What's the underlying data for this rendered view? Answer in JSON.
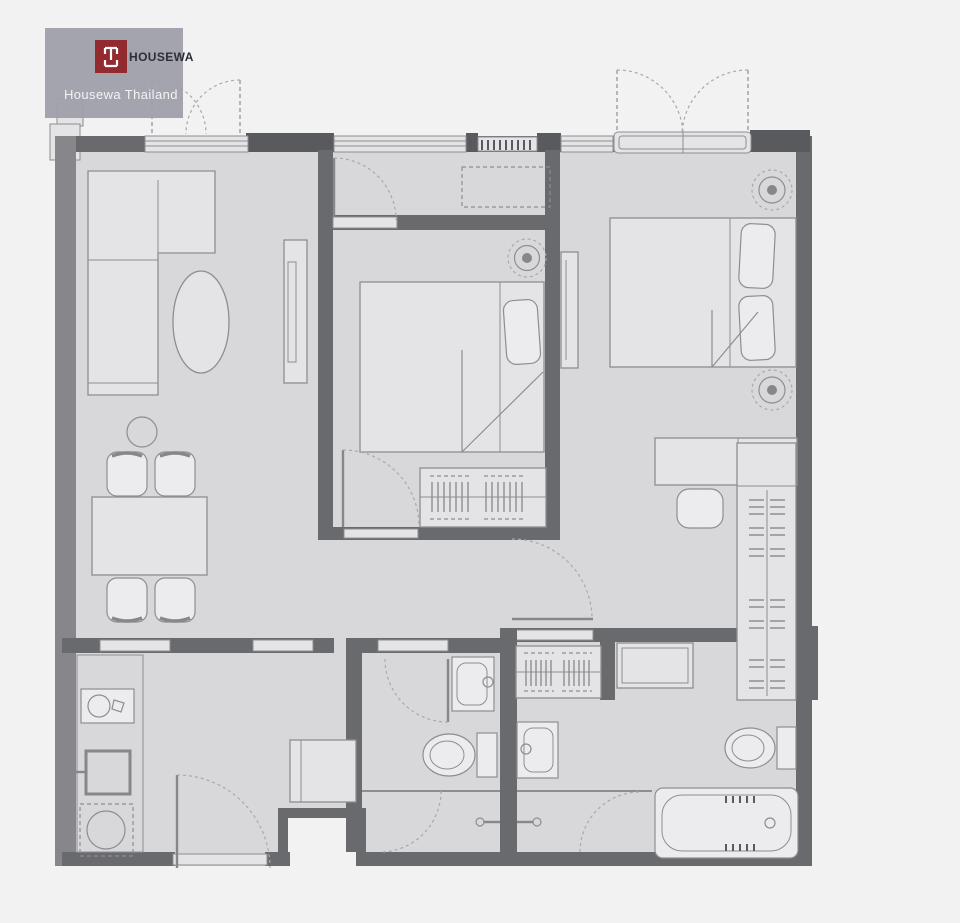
{
  "watermark": {
    "brand": "HOUSEWA",
    "subtitle": "Housewa Thailand"
  },
  "palette": {
    "page_bg": "#f2f2f2",
    "floor": "#d8d8da",
    "floor_light": "#e4e4e6",
    "fixture": "#ececee",
    "wall": "#696a6e",
    "wall_dark": "#595a5e",
    "wall_medium": "#86868b",
    "line": "#8e8e92",
    "line_light": "#a9a9ad",
    "logo_bg": "#a0a0ab",
    "logo_red": "#8d2026",
    "brand_color": "#23242c",
    "subtitle": "#f4f4f6"
  },
  "symbols": [
    "l-shaped-sofa",
    "coffee-table",
    "tv-console",
    "dining-table",
    "dining-chair",
    "planter",
    "double-bed",
    "pillow",
    "wardrobe-with-hangers",
    "ceiling-light",
    "desk",
    "stool",
    "kitchen-counter",
    "kitchen-sink",
    "refrigerator",
    "washing-machine",
    "shoe-cabinet",
    "wash-basin",
    "toilet",
    "shower-enclosure",
    "bathtub",
    "door-swing",
    "window",
    "balcony-french-door",
    "ac-grille",
    "entrance-door"
  ]
}
